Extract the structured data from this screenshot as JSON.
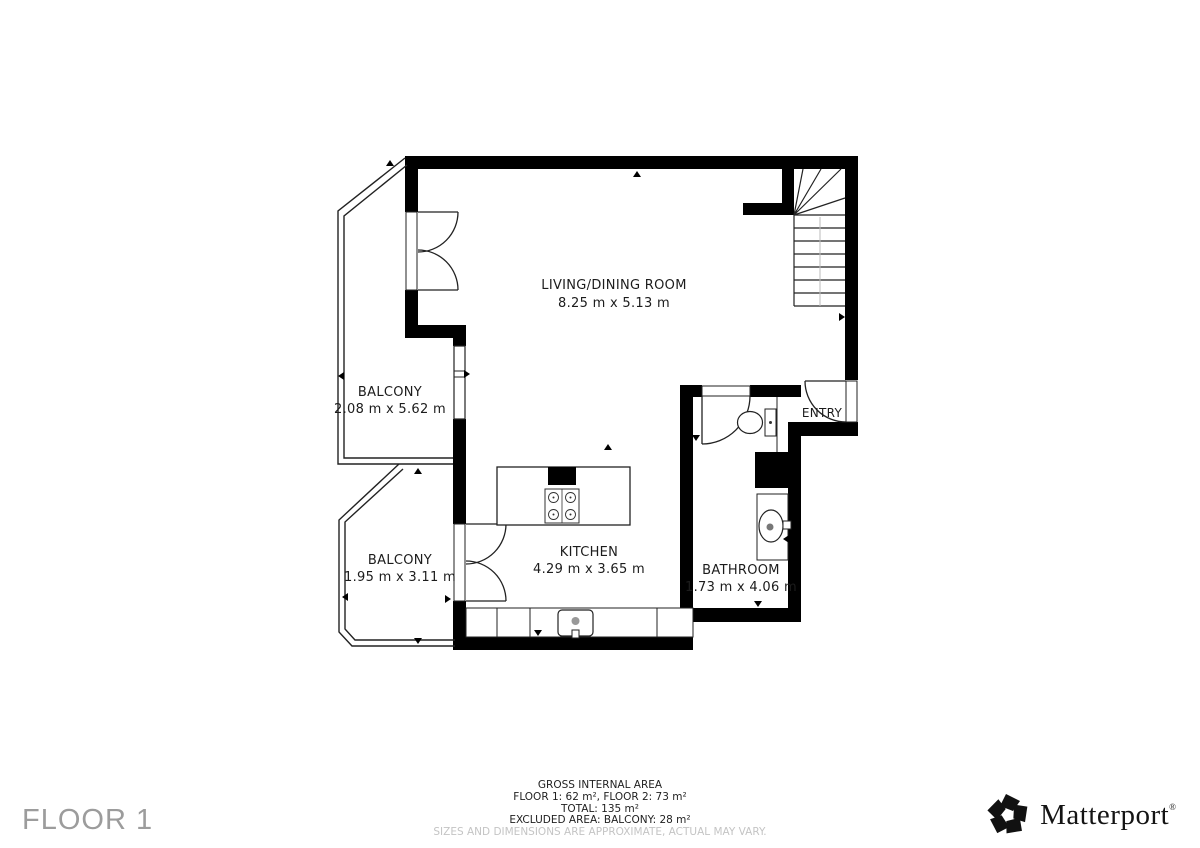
{
  "floor_label": "FLOOR 1",
  "rooms": [
    {
      "name": "LIVING/DINING ROOM",
      "dims": "8.25 m x 5.13 m"
    },
    {
      "name": "BALCONY",
      "dims": "2.08 m x 5.62 m"
    },
    {
      "name": "BALCONY",
      "dims": "1.95 m x 3.11 m"
    },
    {
      "name": "KITCHEN",
      "dims": "4.29 m x 3.65 m"
    },
    {
      "name": "BATHROOM",
      "dims": "1.73 m x 4.06 m"
    },
    {
      "name": "ENTRY",
      "dims": ""
    }
  ],
  "footer": {
    "title": "GROSS INTERNAL AREA",
    "line1": "FLOOR 1: 62 m², FLOOR 2: 73 m²",
    "line2": "TOTAL: 135 m²",
    "line3": "EXCLUDED AREA: BALCONY: 28 m²",
    "disclaimer": "SIZES AND DIMENSIONS ARE APPROXIMATE, ACTUAL MAY VARY."
  },
  "brand": {
    "name": "Matterport",
    "registered": "®"
  },
  "colors": {
    "wall": "#000000",
    "thin_line": "#222222",
    "label": "#1c1c1c",
    "floor_label": "#9c9c9c",
    "disclaimer": "#c4c4c4"
  }
}
